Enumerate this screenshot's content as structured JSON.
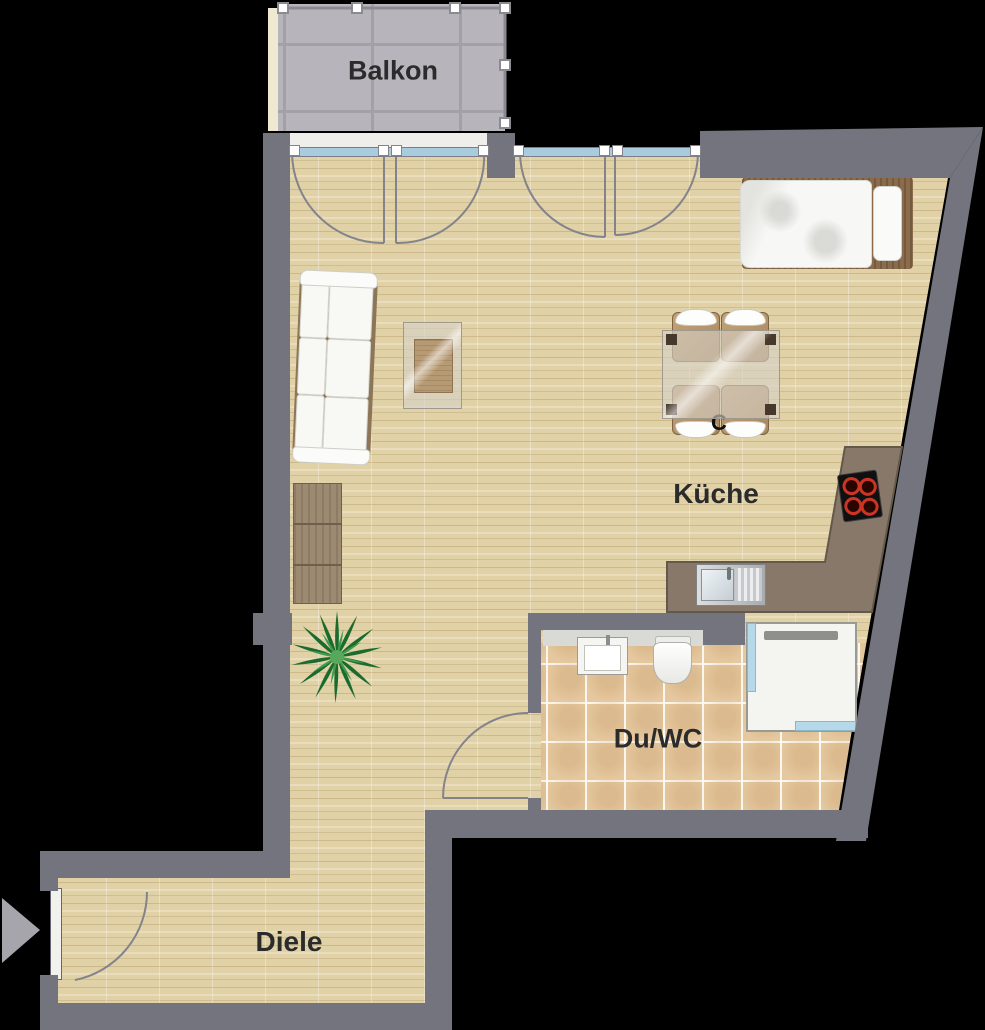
{
  "plan_title": "apartment-floorplan",
  "rooms": {
    "balkon": {
      "label": "Balkon"
    },
    "kueche": {
      "label": "Küche"
    },
    "du_wc": {
      "label": "Du/WC"
    },
    "diele": {
      "label": "Diele"
    }
  },
  "annotations": {
    "partial_letter": "C"
  },
  "furniture_icons": [
    "sofa",
    "coffee-table",
    "sideboard",
    "plant",
    "bed",
    "dining-table",
    "dining-chair",
    "kitchen-counter",
    "stove",
    "kitchen-sink",
    "wash-basin",
    "toilet",
    "shower",
    "entrance-arrow",
    "door-swing",
    "balcony-railing"
  ],
  "colors": {
    "background": "#000000",
    "wall": "#74747e",
    "wood_floor": "#e1d1a7",
    "bath_tile": "#e5c89f",
    "balcony_tile": "#b7b5bb",
    "kitchen_counter": "#87786a",
    "window_glass": "#a9cbde",
    "plant_green": "#27813a",
    "burner_red": "#cc3524",
    "label_text": "#2b2b2b"
  }
}
